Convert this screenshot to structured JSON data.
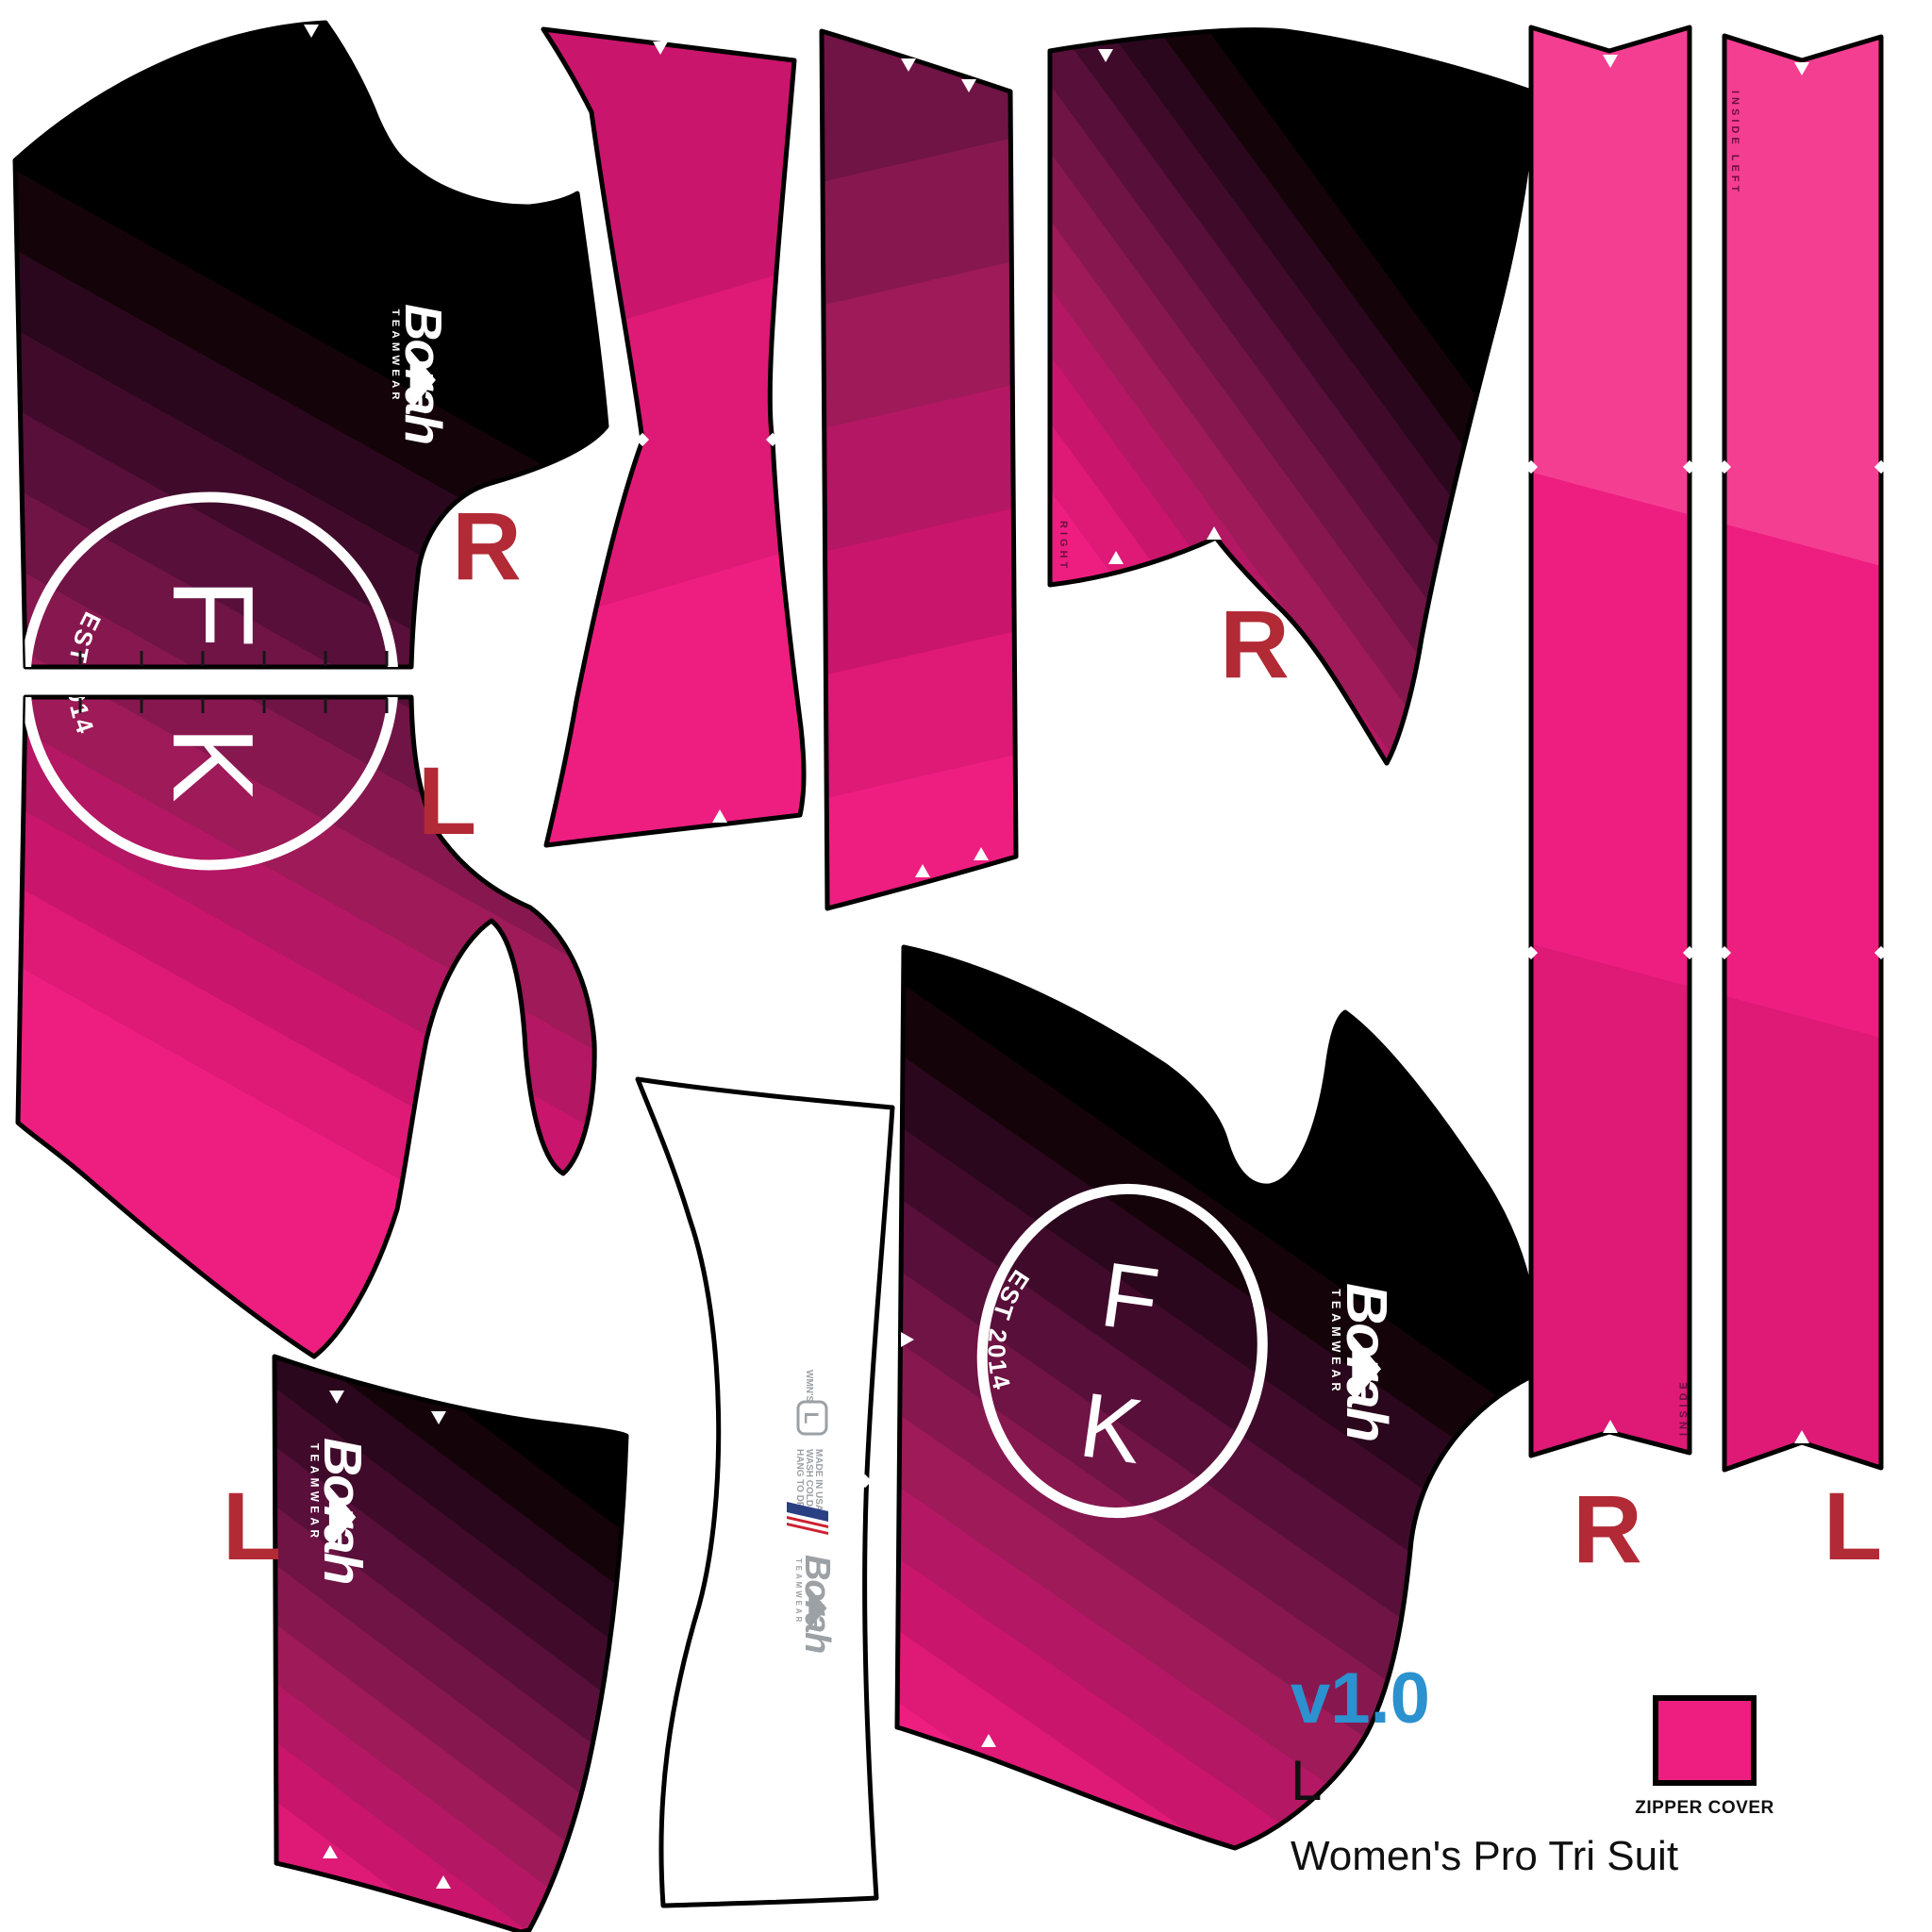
{
  "title_block": {
    "version": "v1.0",
    "size": "L",
    "product_name": "Women's Pro Tri Suit"
  },
  "zipper_cover_label": "ZIPPER COVER",
  "team_logo": {
    "letter_f": "F",
    "letter_k": "K",
    "established": "EST 2014"
  },
  "brand": {
    "name": "Borah",
    "subtitle": "TEAMWEAR"
  },
  "care_label": {
    "garment_tag": "WMN'S",
    "size": "L",
    "instructions": [
      "MADE IN USA",
      "WASH COLD",
      "HANG TO DRY"
    ]
  },
  "labels": {
    "front_upper": "R",
    "front_lower": "L",
    "shorts_right": "R",
    "back_left": "L",
    "strip_right": "R",
    "strip_left": "L"
  },
  "edge_texts": {
    "shorts_right": "RIGHT",
    "strip_right": "INSIDE",
    "strip_left": "INSIDE LEFT"
  },
  "colors": {
    "background": "#FFFFFF",
    "hot_pink": "#EE1E80",
    "label_red": "#B22A35",
    "version_blue": "#2B91CF",
    "care_gray": "#9CA1A6",
    "flag_blue": "#2B3F85",
    "flag_red": "#CE2030",
    "outline_black": "#000000",
    "gradient_bands": [
      "#F43E92",
      "#EE1E80",
      "#DE1976",
      "#C9156C",
      "#B41763",
      "#9E1A58",
      "#87184F",
      "#6F1445",
      "#580F3A",
      "#400B2B",
      "#2A071C",
      "#140309",
      "#000000"
    ]
  }
}
